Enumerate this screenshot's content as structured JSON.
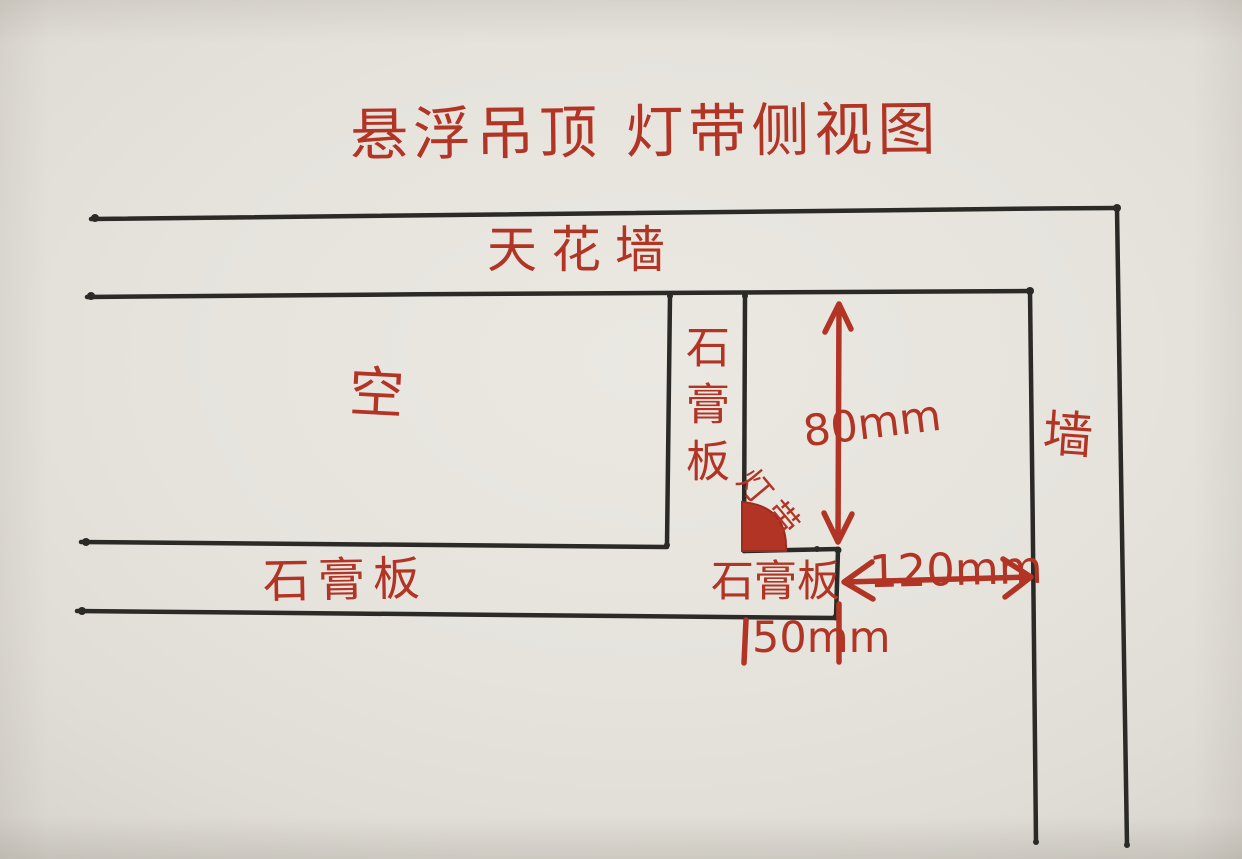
{
  "title": "悬浮吊顶 灯带侧视图",
  "labels": {
    "ceiling": "天花墙",
    "cavity": "空",
    "gypsum_vertical": "石膏板",
    "led_strip": "灯带",
    "gypsum_shelf": "石膏板",
    "gypsum_bottom": "石膏板",
    "wall": "墙"
  },
  "dimensions": {
    "drop_height": "80mm",
    "gap_to_wall": "120mm",
    "lip_width": "50mm"
  },
  "colors": {
    "ink_red": "#b23425",
    "line_black": "#2b2a27",
    "paper": "#e6e3dd"
  }
}
